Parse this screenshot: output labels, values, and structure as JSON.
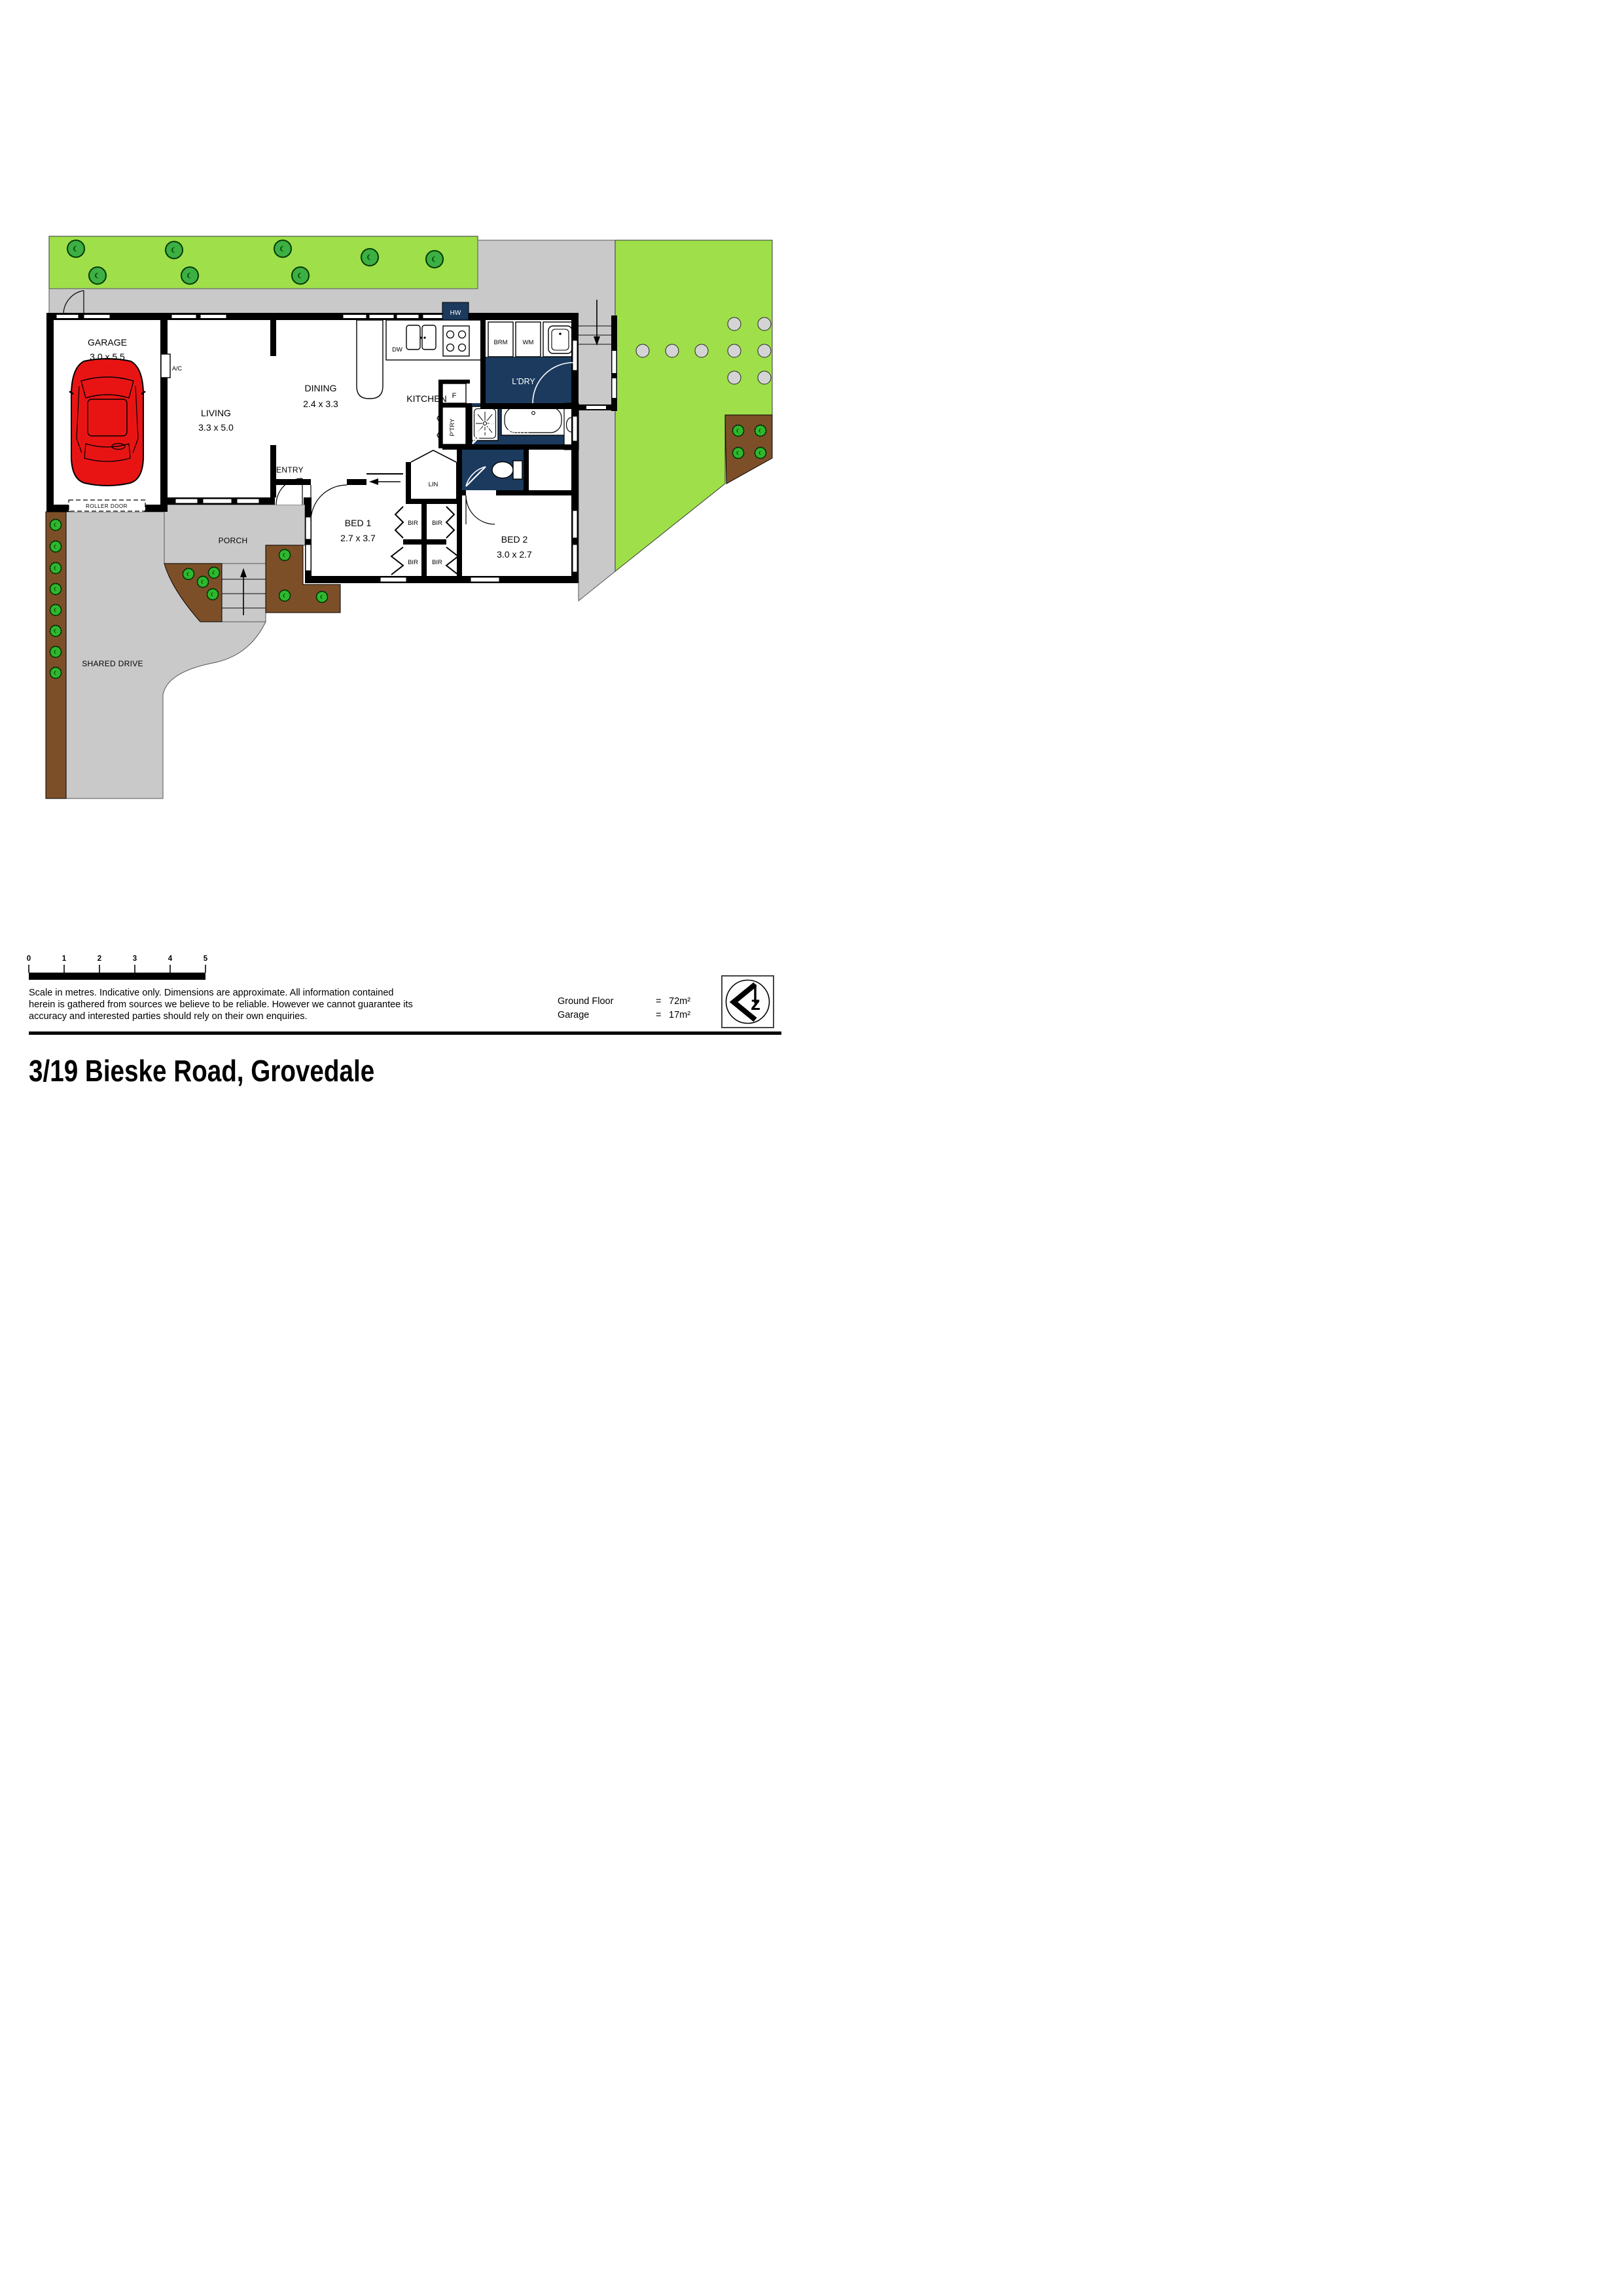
{
  "plan": {
    "rooms": {
      "garage": {
        "name": "GARAGE",
        "dims": "3.0 x 5.5"
      },
      "living": {
        "name": "LIVING",
        "dims": "3.3 x 5.0"
      },
      "dining": {
        "name": "DINING",
        "dims": "2.4 x 3.3"
      },
      "kitchen": {
        "name": "KITCHEN"
      },
      "laundry": {
        "name": "L'DRY"
      },
      "bath": {
        "name": "BATH"
      },
      "entry": {
        "name": "ENTRY"
      },
      "porch": {
        "name": "PORCH"
      },
      "bed1": {
        "name": "BED 1",
        "dims": "2.7 x 3.7"
      },
      "bed2": {
        "name": "BED 2",
        "dims": "3.0 x 2.7"
      },
      "shared_drive": {
        "name": "SHARED DRIVE"
      }
    },
    "fixtures": {
      "hw": "HW",
      "dw": "DW",
      "brm": "BRM",
      "wm": "WM",
      "ac": "A/C",
      "fridge": "F",
      "pantry": "P'TRY",
      "linen": "LIN",
      "bir": "BIR",
      "roller_door": "ROLLER DOOR"
    },
    "colors": {
      "grass": "#9fe04a",
      "tree": "#3cb043",
      "navy": "#1b3a5e",
      "concrete": "#c9c9c9",
      "soil": "#7d4f28",
      "car": "#e81414"
    }
  },
  "scalebar": {
    "ticks": [
      "0",
      "1",
      "2",
      "3",
      "4",
      "5"
    ]
  },
  "footer": {
    "disclaimer_lines": [
      "Scale in metres. Indicative only. Dimensions are approximate. All information contained",
      "herein is gathered from sources we believe to be reliable. However we cannot guarantee its",
      "accuracy and interested parties should rely on their own enquiries."
    ],
    "areas": [
      {
        "label": "Ground Floor",
        "eq": "=",
        "value": "72m²"
      },
      {
        "label": "Garage",
        "eq": "=",
        "value": "17m²"
      }
    ],
    "compass_letter": "z"
  },
  "title": "3/19 Bieske Road, Grovedale"
}
